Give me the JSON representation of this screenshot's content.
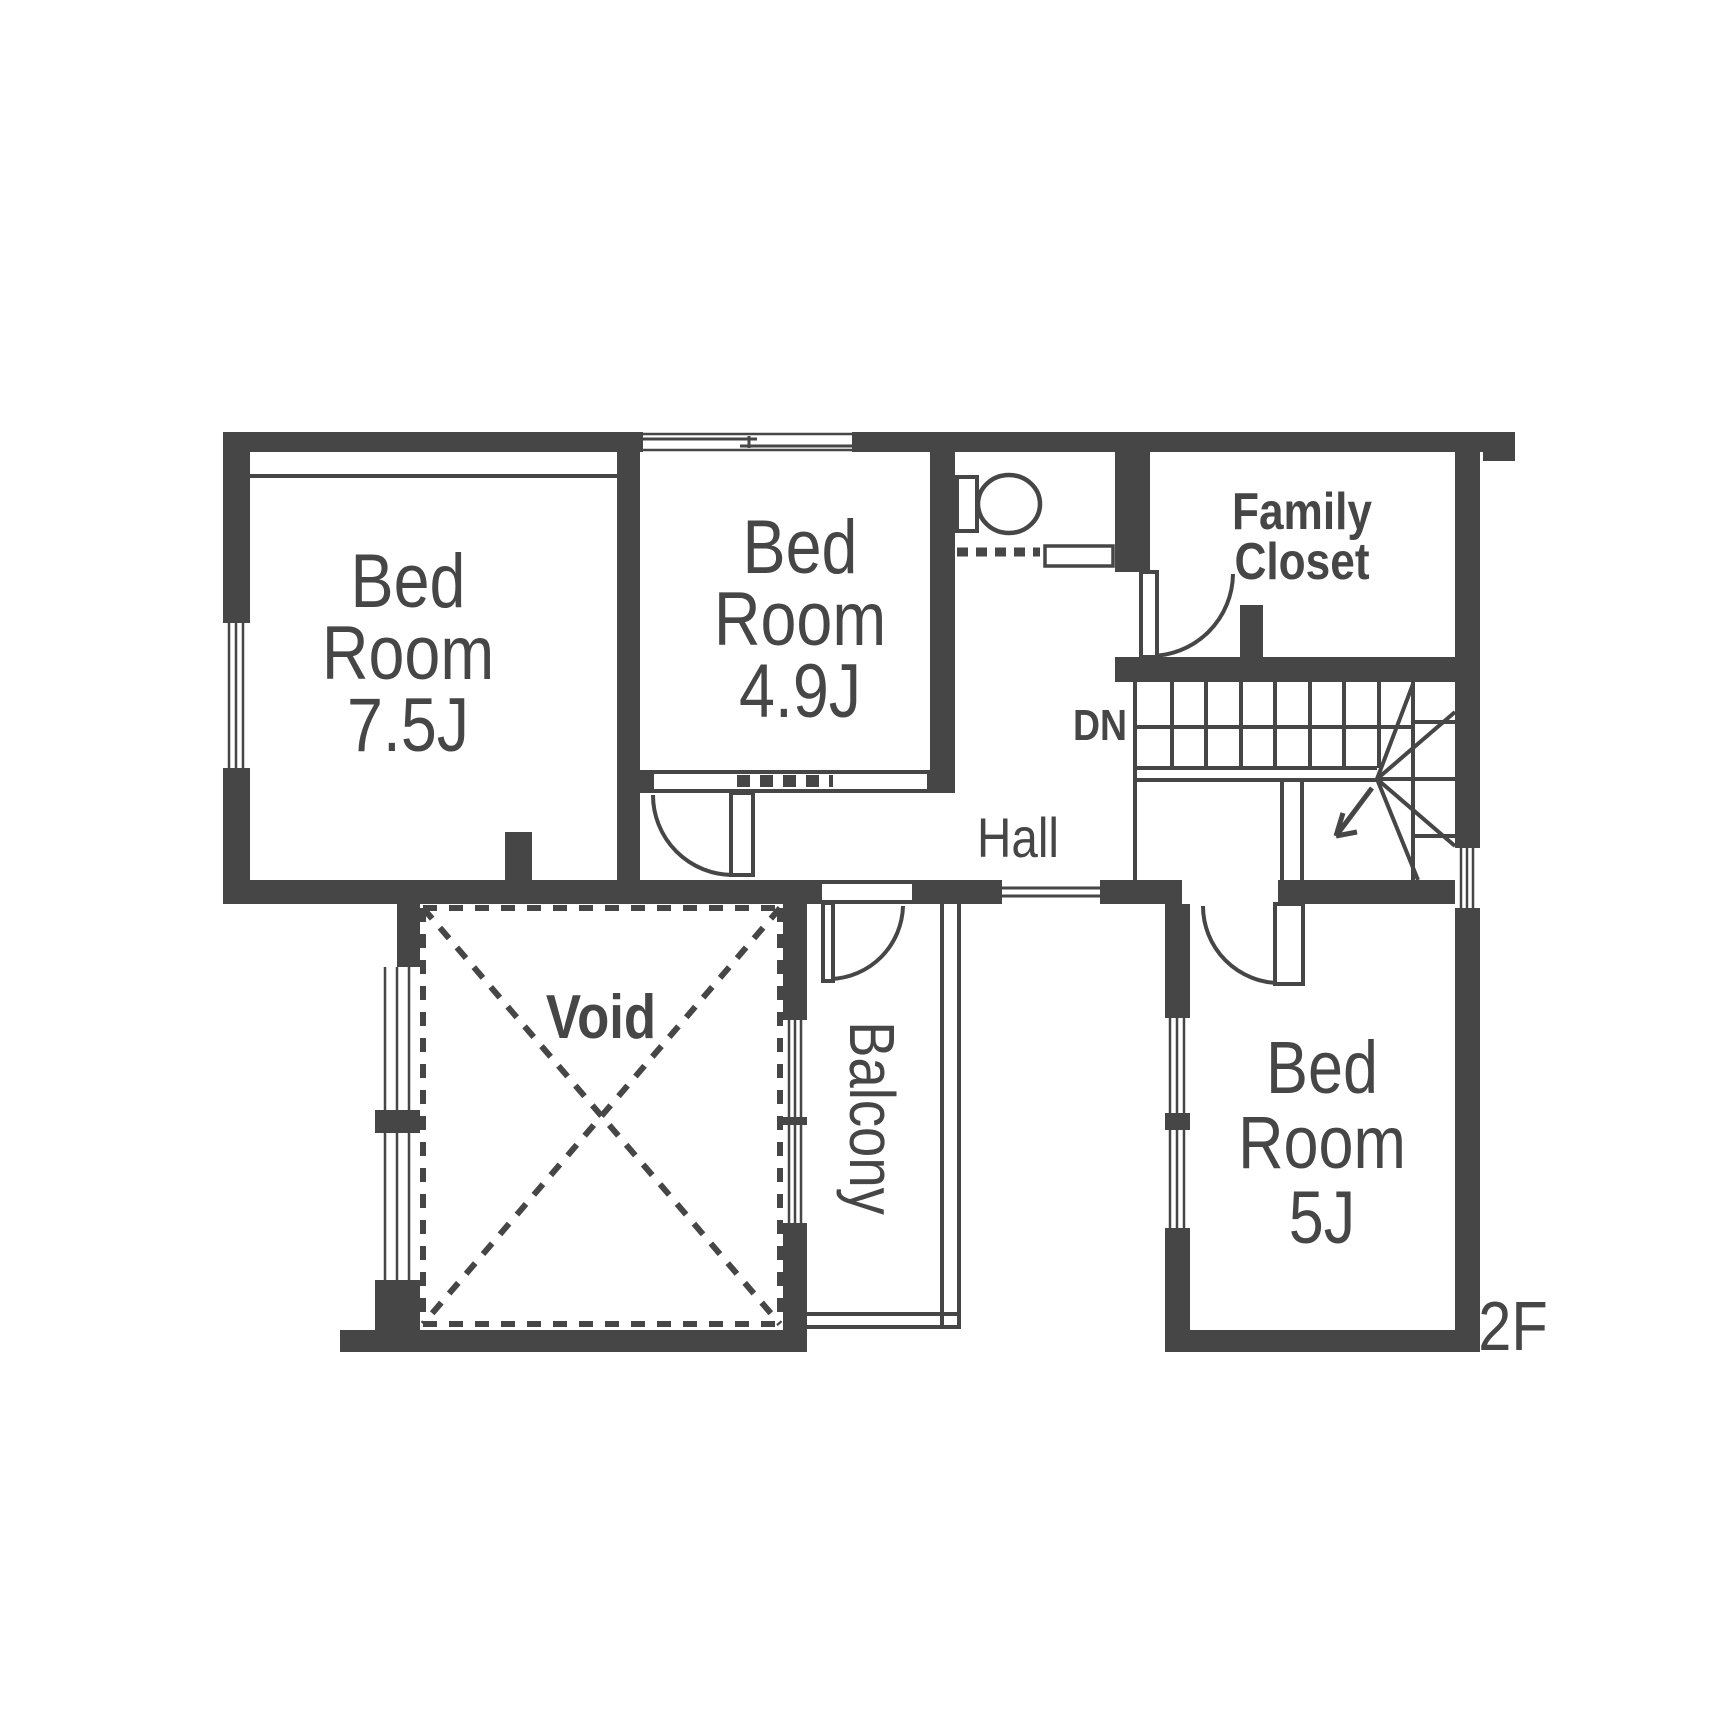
{
  "floor_label": "2F",
  "colors": {
    "wall": "#464646",
    "background": "#ffffff",
    "text": "#464646"
  },
  "rooms": {
    "bedroom1": {
      "line1": "Bed",
      "line2": "Room",
      "size": "7.5J"
    },
    "bedroom2": {
      "line1": "Bed",
      "line2": "Room",
      "size": "4.9J"
    },
    "bedroom3": {
      "line1": "Bed",
      "line2": "Room",
      "size": "5J"
    },
    "family_closet": {
      "line1": "Family",
      "line2": "Closet"
    },
    "hall": {
      "label": "Hall"
    },
    "void": {
      "label": "Void"
    },
    "balcony": {
      "label": "Balcony"
    }
  },
  "stairs": {
    "down_label": "DN"
  },
  "icons": {
    "toilet": "toilet-icon",
    "stair_arrow": "stair-down-arrow-icon"
  }
}
